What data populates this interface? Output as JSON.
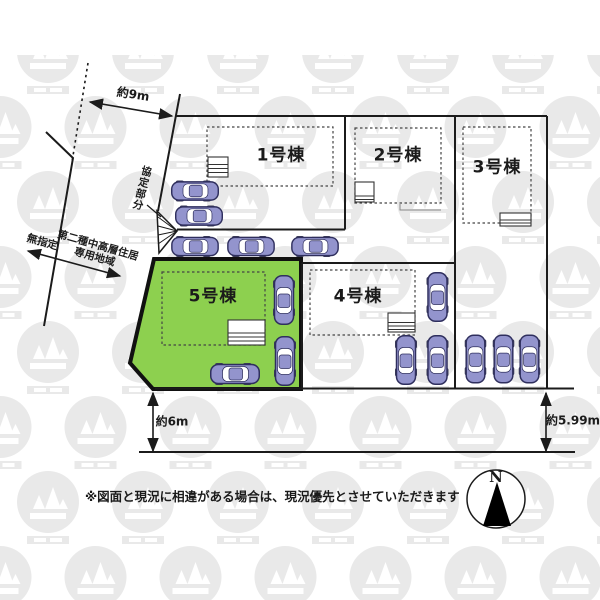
{
  "lots": [
    {
      "label": "1号棟"
    },
    {
      "label": "2号棟"
    },
    {
      "label": "3号棟"
    },
    {
      "label": "4号棟"
    },
    {
      "label": "5号棟"
    }
  ],
  "dimensions": {
    "top": "約9m",
    "left": "約6m",
    "right": "約5.99m"
  },
  "zoning": {
    "left_label": "無指定",
    "right_label_line1": "第二種中高層住居",
    "right_label_line2": "専用地域"
  },
  "agreement_label": "協定部分",
  "note": "※図面と現況に相違がある場合は、現況優先とさせていただきます",
  "compass": {
    "north": "N"
  },
  "colors": {
    "highlight_lot": "#8dd04f",
    "car_body": "#9394cd",
    "car_outline": "#2f2f5e",
    "line": "#1b1b1b",
    "watermark": "#e9e9e9"
  }
}
